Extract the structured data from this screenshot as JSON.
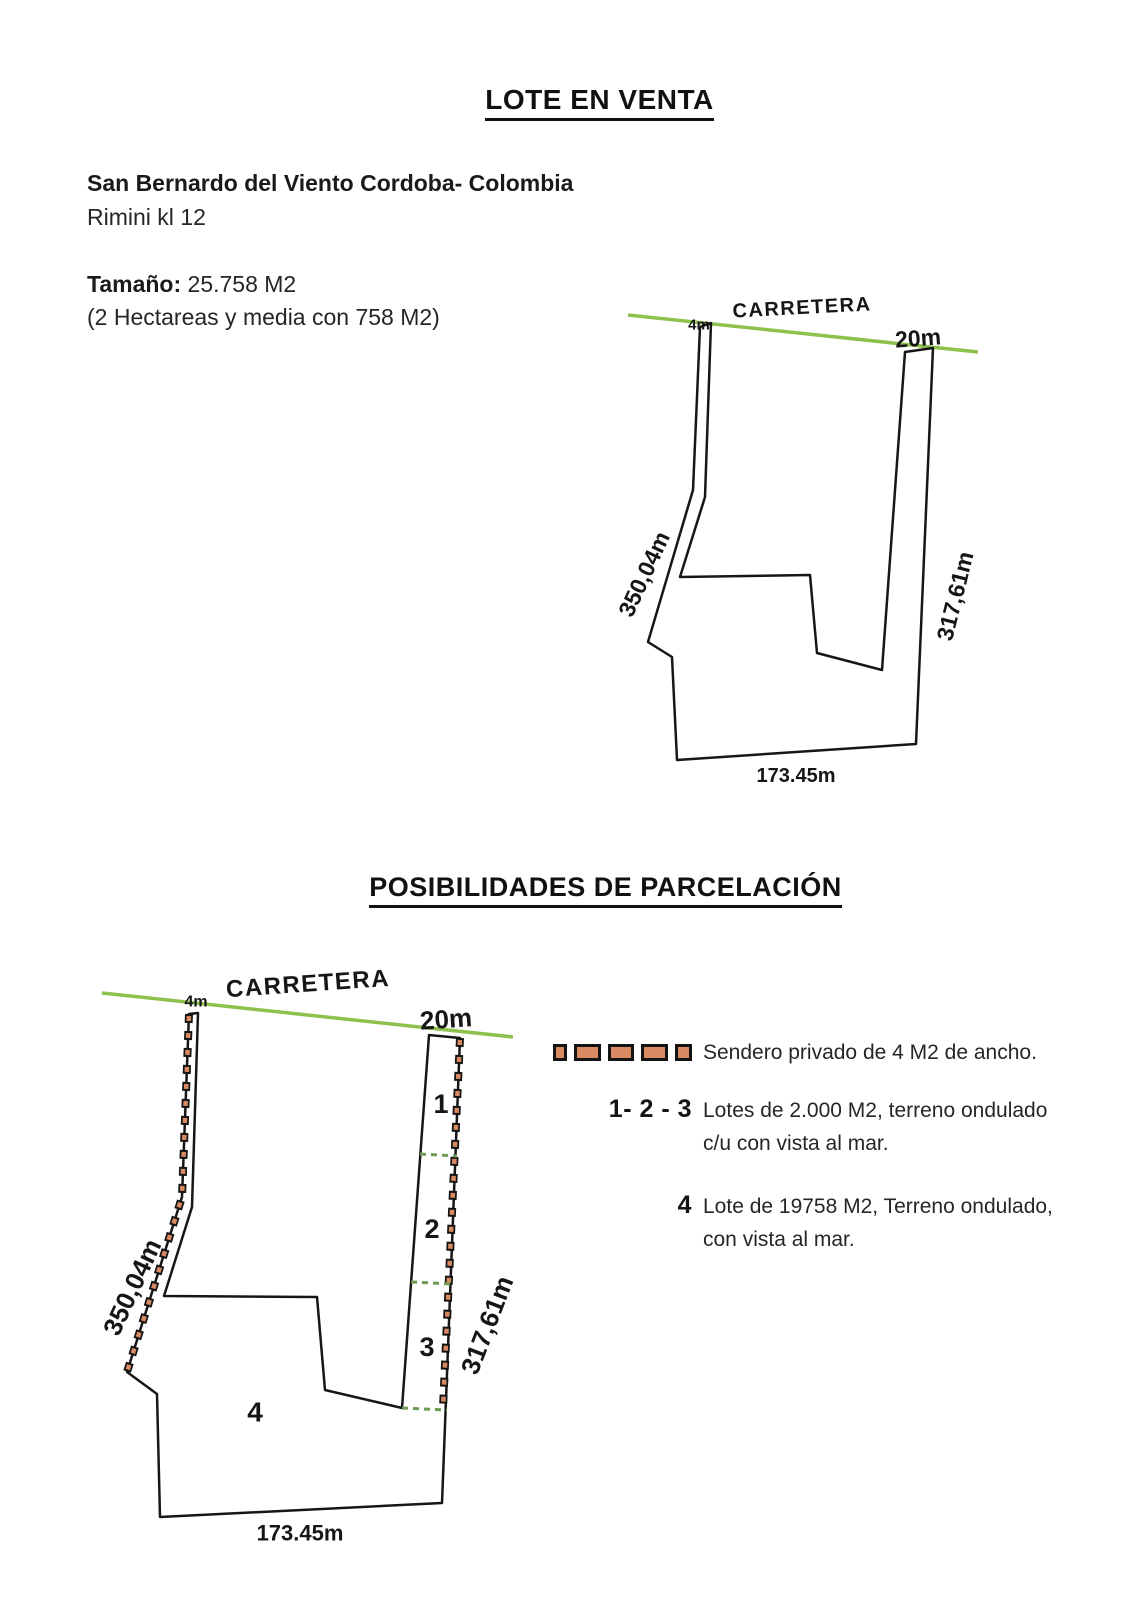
{
  "page": {
    "title": "LOTE EN VENTA"
  },
  "info": {
    "location_line1": "San Bernardo del Viento Cordoba- Colombia",
    "location_line2": "Rimini kl 12",
    "size_label": "Tamaño:",
    "size_value": "25.758 M2",
    "size_note": "(2 Hectareas y media con 758 M2)"
  },
  "section2": {
    "title": "POSIBILIDADES DE PARCELACIÓN"
  },
  "diagram": {
    "road_label": "CARRETERA",
    "width_left": "4m",
    "width_right": "20m",
    "side_left": "350,04m",
    "side_right": "317,61m",
    "bottom": "173.45m"
  },
  "parcels": {
    "p1": "1",
    "p2": "2",
    "p3": "3",
    "p4": "4"
  },
  "legend": {
    "sendero": "Sendero privado de 4 M2 de ancho.",
    "lots123_label": "1- 2 - 3",
    "lots123_line1": "Lotes de 2.000 M2, terreno ondulado",
    "lots123_line2": "c/u con vista al mar.",
    "lot4_label": "4",
    "lot4_line1": "Lote de 19758 M2, Terreno ondulado,",
    "lot4_line2": "con vista al mar."
  },
  "colors": {
    "road_green": "#8ec04e",
    "sendero_fill": "#d98a63",
    "sendero_border": "#141414",
    "divider_green": "#6f9a55",
    "outline_black": "#161616"
  }
}
